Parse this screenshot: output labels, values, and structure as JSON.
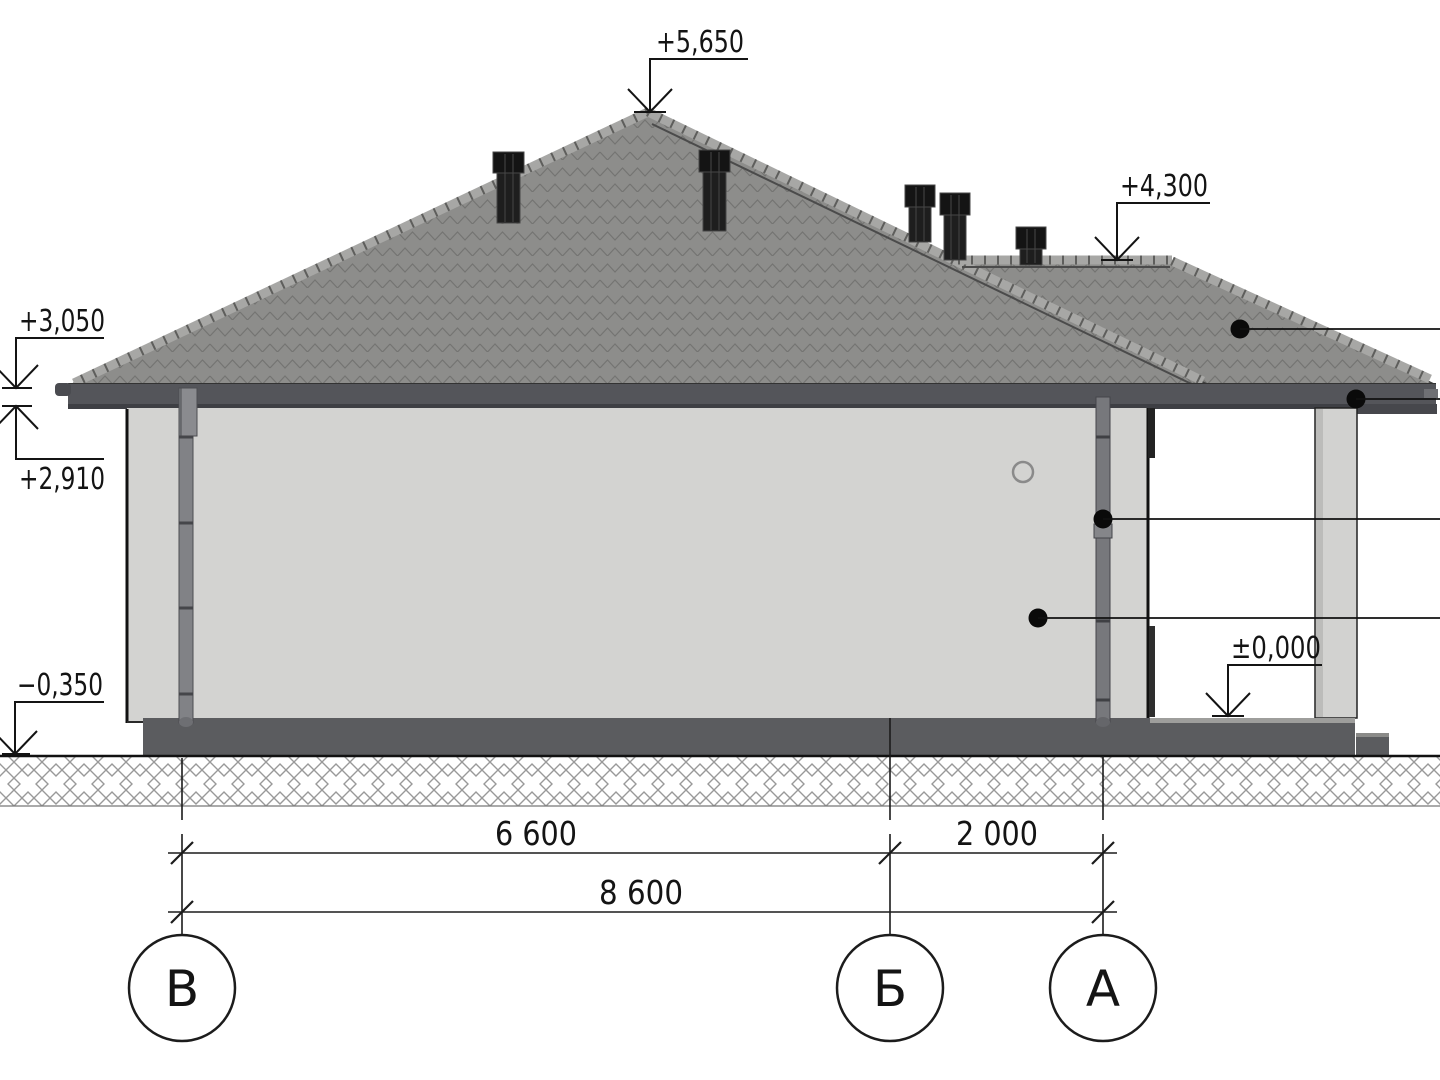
{
  "drawing": {
    "elevations": {
      "peak": "+5,650",
      "porch_ridge": "+4,300",
      "eave_top": "+3,050",
      "eave_bottom": "+2,910",
      "ground": "−0,350",
      "porch_floor": "±0,000"
    },
    "dimensions": {
      "span_vb": "6 600",
      "span_ba": "2 000",
      "total": "8 600"
    },
    "axes": {
      "left": "В",
      "middle": "Б",
      "right": "А"
    },
    "colors": {
      "roof": "#8d8d8b",
      "roof_cap": "#a7a7a5",
      "fascia": "#54555a",
      "wall": "#d3d3d1",
      "plinth": "#5b5c5f",
      "column": "#d2d2d0",
      "line": "#1c1c1c"
    }
  }
}
